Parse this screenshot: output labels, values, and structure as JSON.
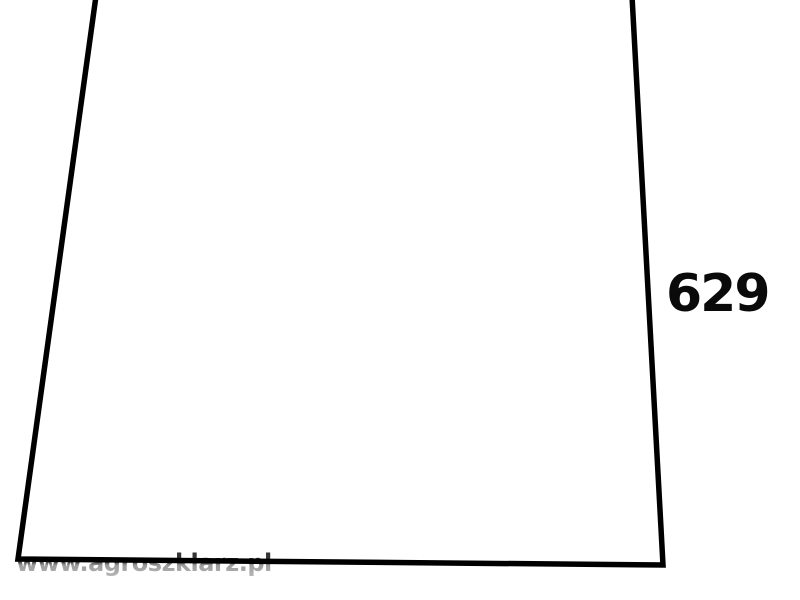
{
  "figure": {
    "type": "glass-pane-outline-diagram",
    "part_number": "629",
    "watermark": "www.agroszklarz.pl",
    "background_color": "#ffffff",
    "line_color": "#000000",
    "label_color": "#0a0a0a",
    "watermark_color": "#6e6e6e"
  },
  "shape": {
    "description": "trapezoid outline, open at top edge (left, bottom and right sides drawn; top cut off by image edge)",
    "points": "96,-4 18,559 663,565 632,-4",
    "stroke_width": "5.5"
  }
}
